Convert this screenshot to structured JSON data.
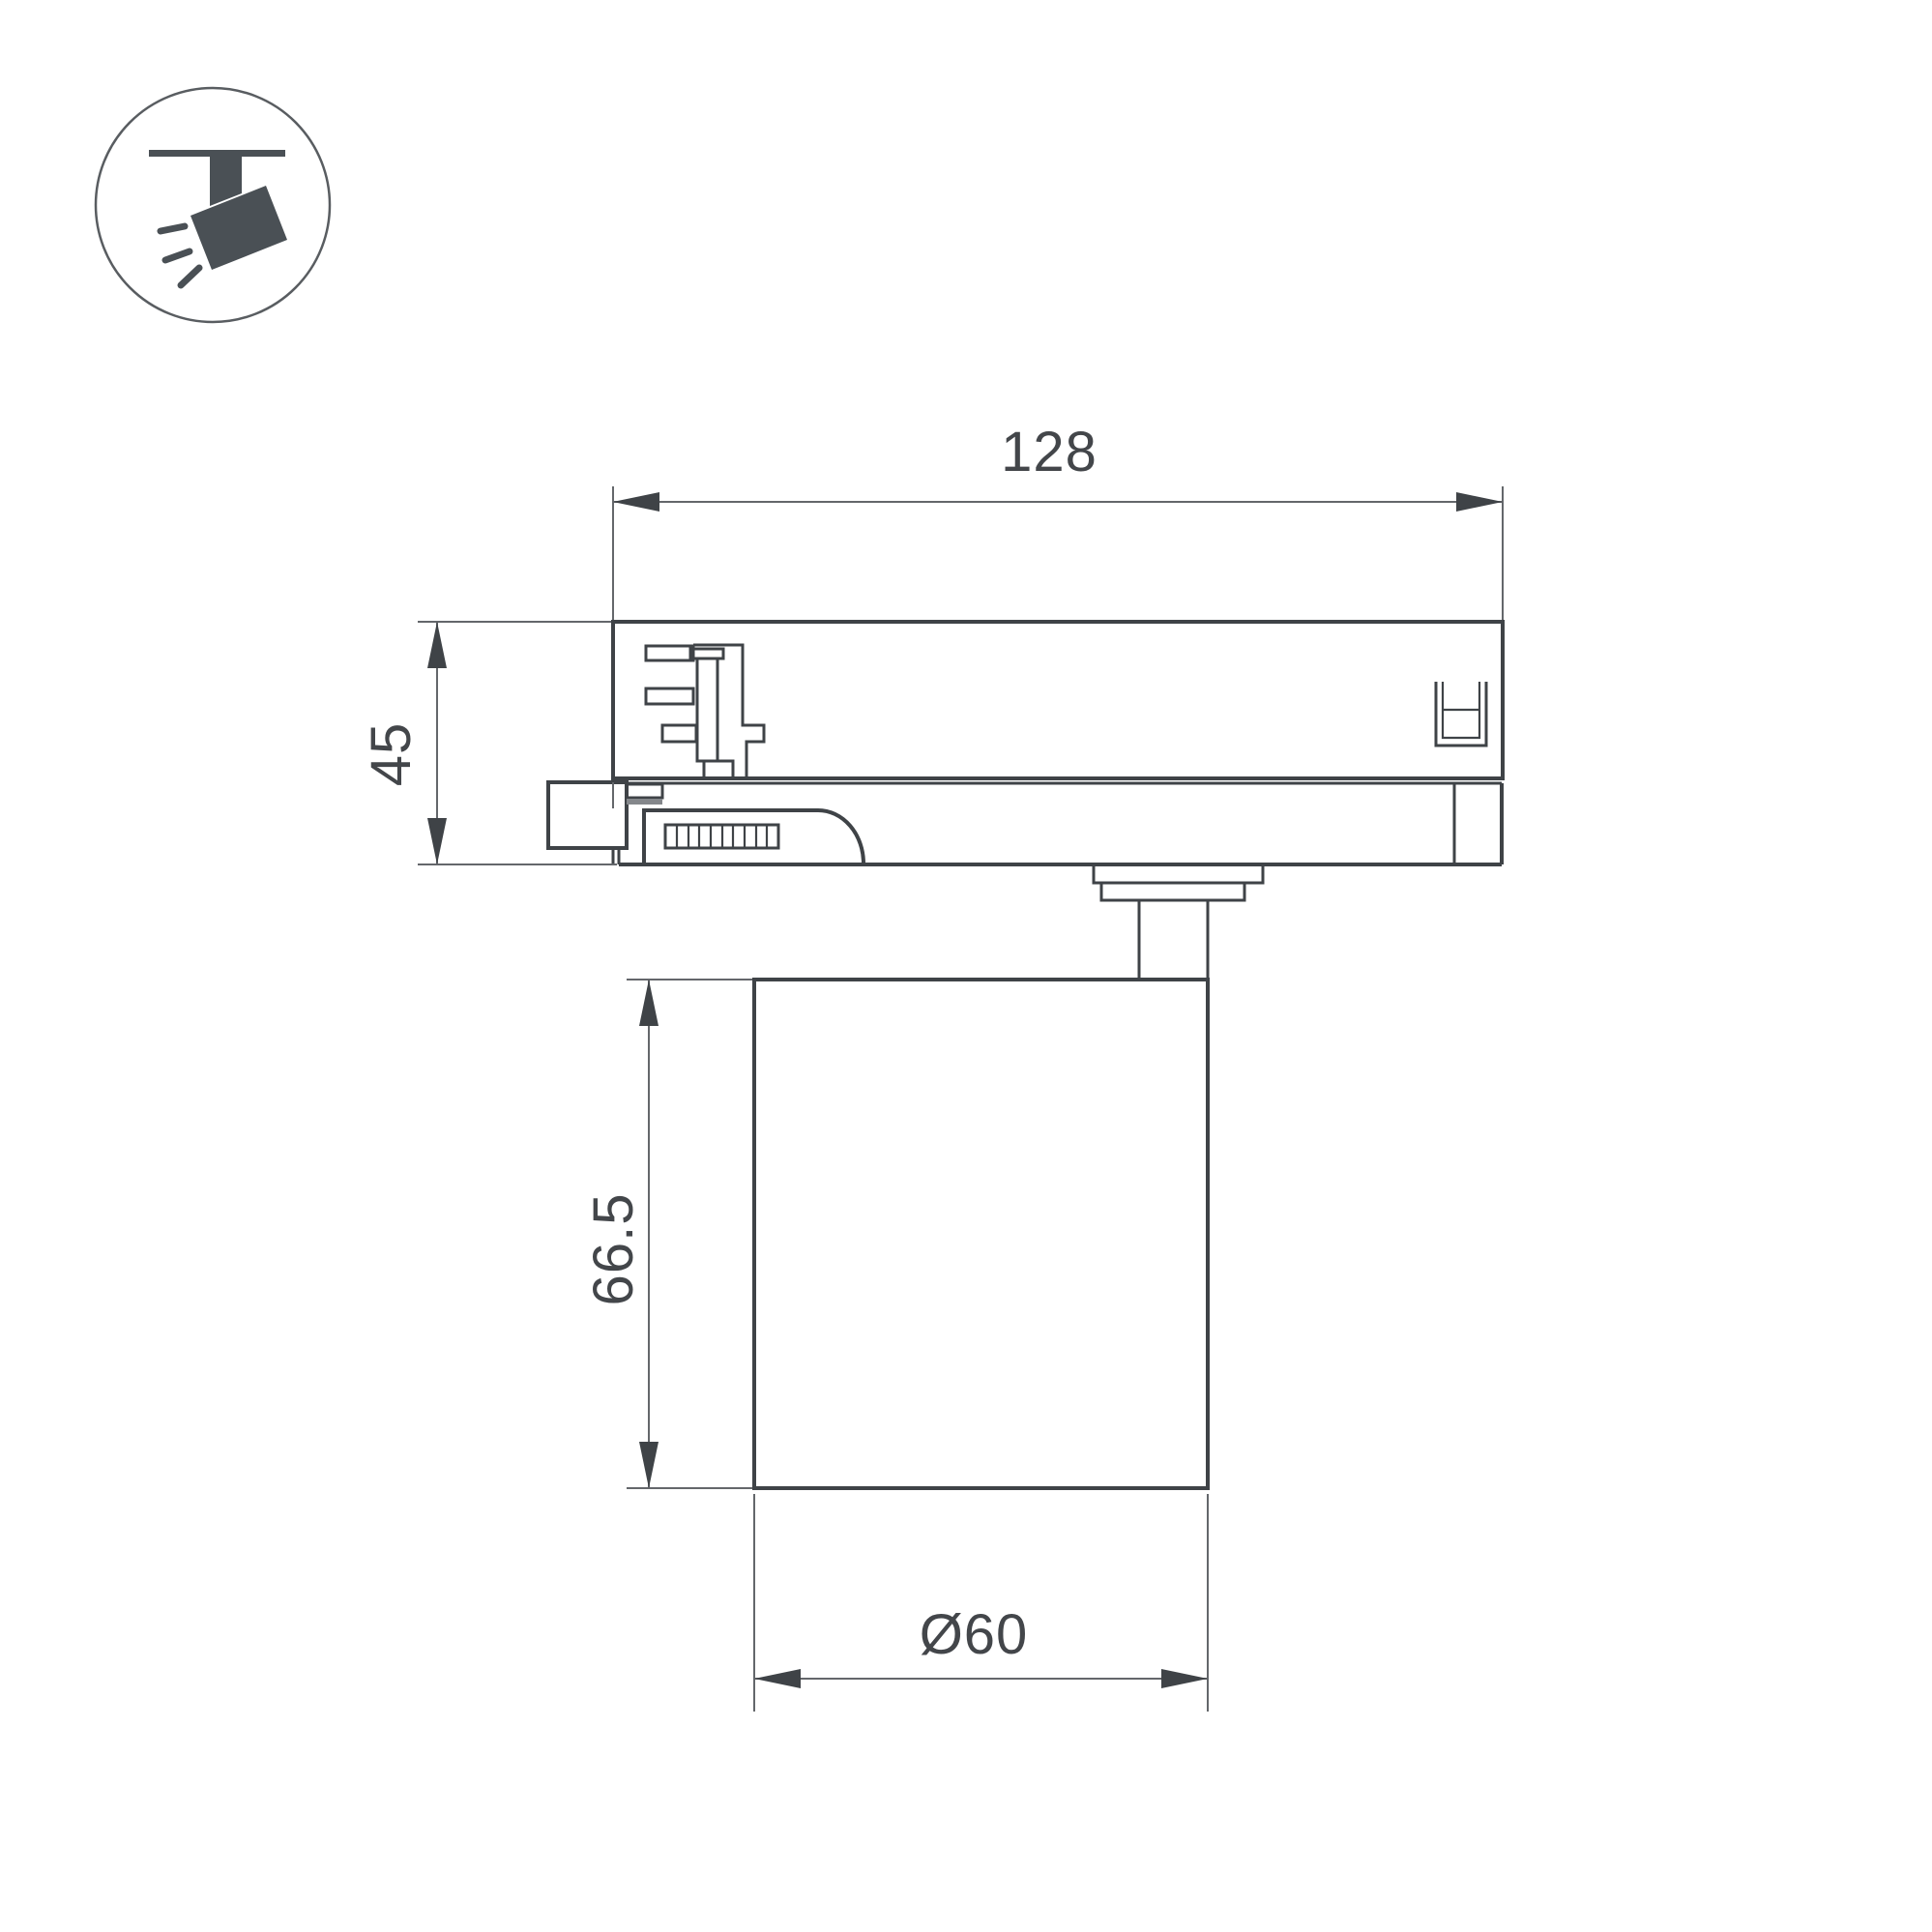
{
  "theme": {
    "background": "#ffffff",
    "line_bold": "#3f4347",
    "line_thin": "#64676b",
    "text_color": "#43464a",
    "icon_color": "#4a5055"
  },
  "icon": {
    "type": "ceiling-track-spotlight-pictogram"
  },
  "drawing": {
    "type": "technical-dimension-drawing",
    "views": {
      "top": "track-adapter-side-view",
      "bottom": "cylindrical-lamp-body-side-view"
    },
    "dimensions": {
      "track_width": "128",
      "adapter_height": "45",
      "body_height": "66.5",
      "body_diameter": "Ø60"
    }
  }
}
